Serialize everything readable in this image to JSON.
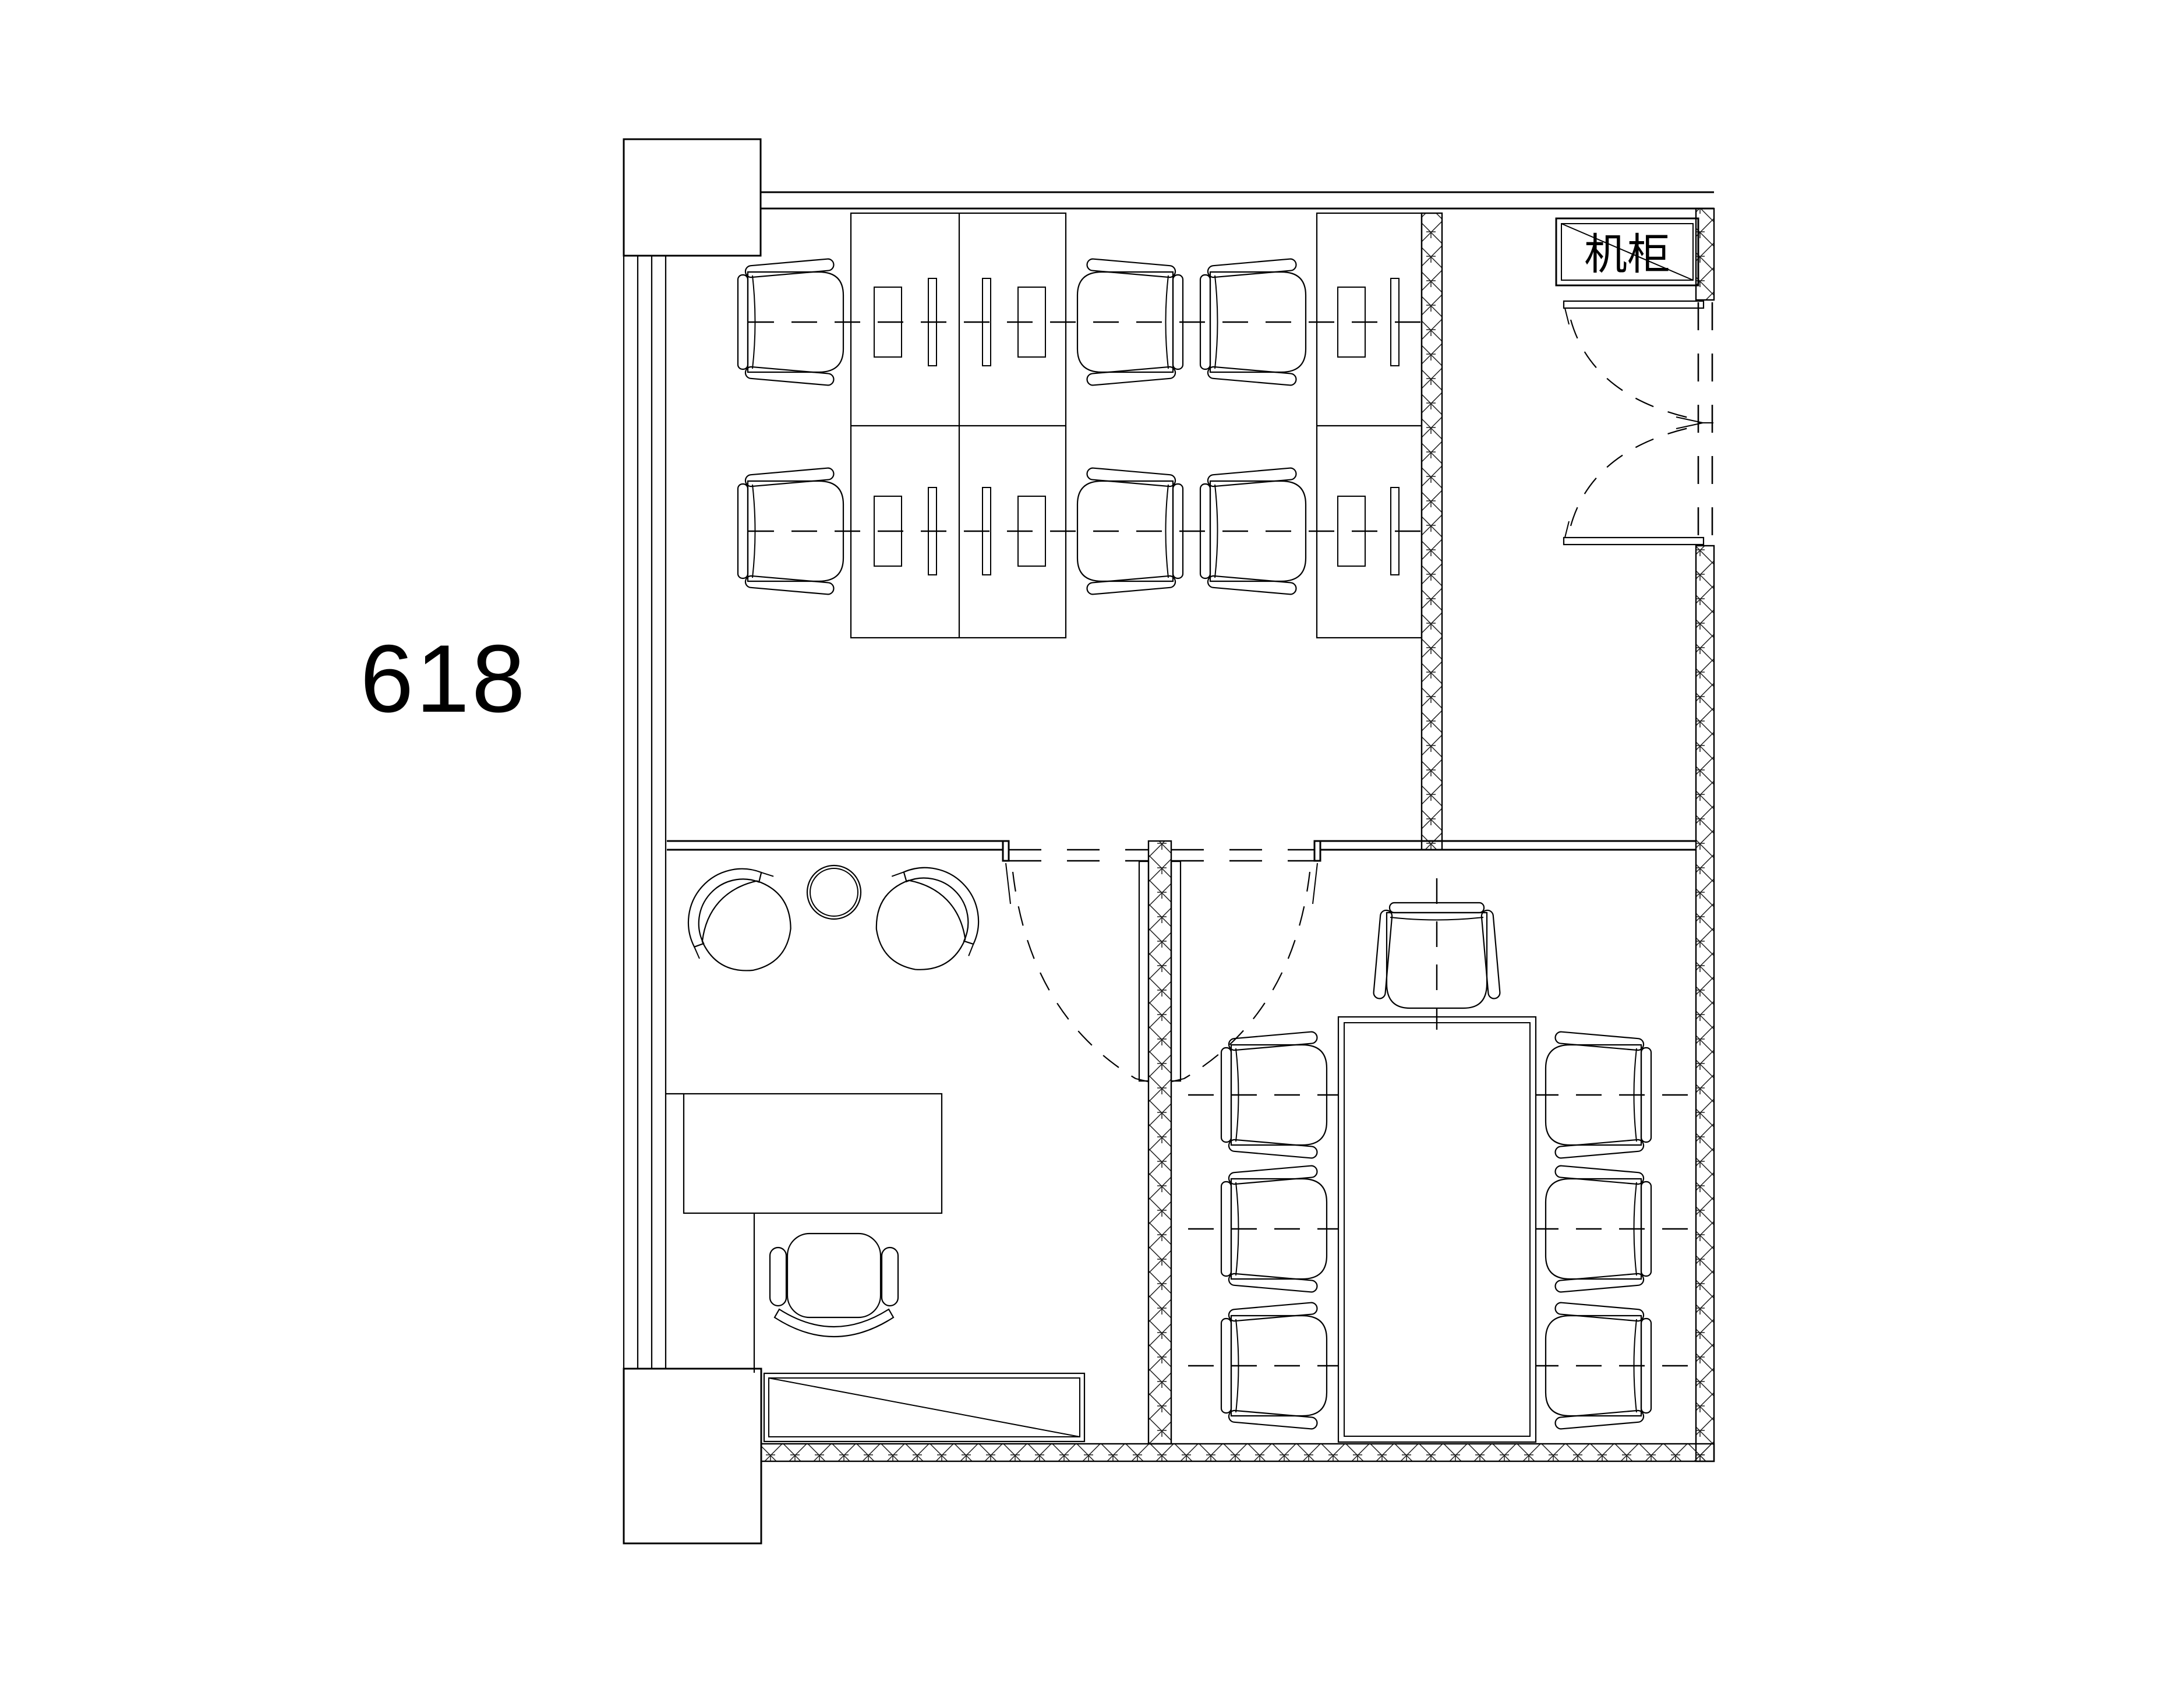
{
  "drawing": {
    "type": "floor-plan",
    "background_color": "#ffffff",
    "line_color": "#000000"
  },
  "labels": {
    "room_number": "618",
    "cabinet": "机柜"
  },
  "furniture": {
    "workstation_desks": 6,
    "workstation_chairs": 6,
    "meeting_table": 1,
    "meeting_side_chairs": 6,
    "meeting_head_chair": 1,
    "lounge_chairs": 2,
    "lounge_round_table": 1,
    "executive_desk": 1,
    "executive_chair": 1,
    "sideboard": 1,
    "server_cabinet": 1,
    "doors": 3
  }
}
